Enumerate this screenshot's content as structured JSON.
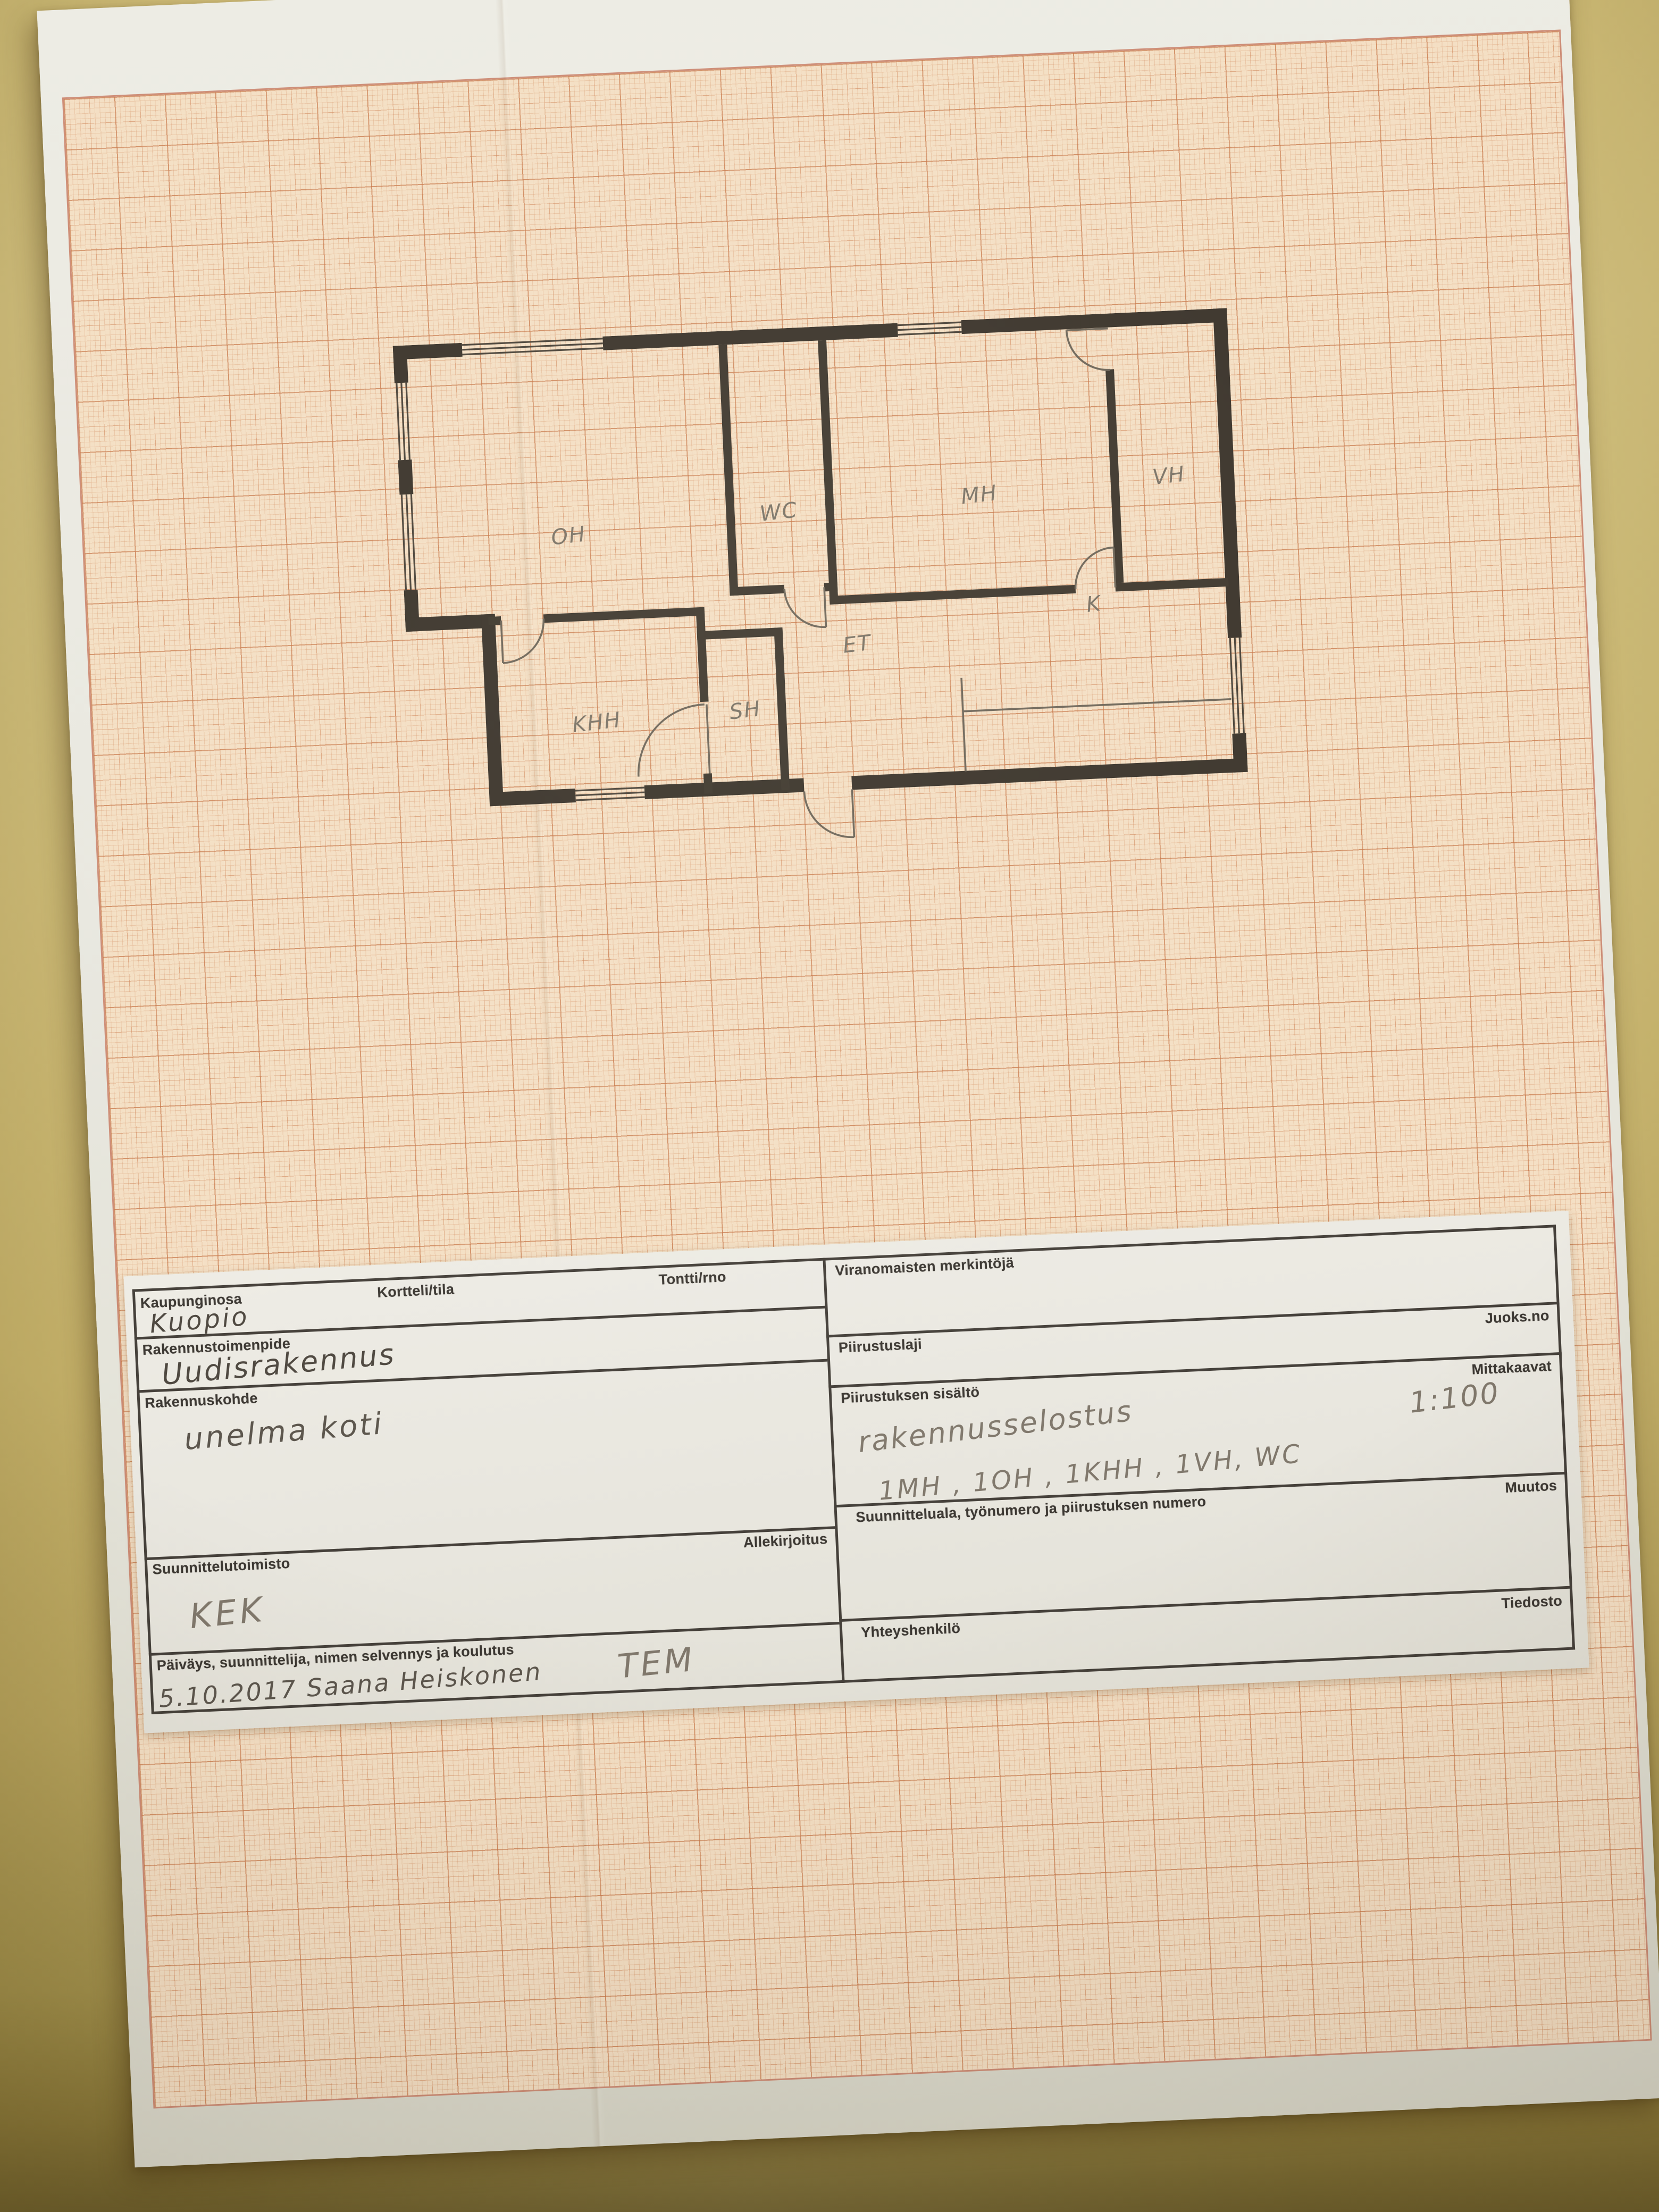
{
  "floor_plan": {
    "rooms": {
      "oh": "OH",
      "wc": "WC",
      "mh": "MH",
      "vh": "VH",
      "k": "K",
      "et": "ET",
      "khh": "KHH",
      "sh": "SH"
    },
    "scale_note": "1:100"
  },
  "title_block": {
    "kaupunginosa": {
      "label": "Kaupunginosa",
      "value": "Kuopio"
    },
    "kortteli": {
      "label": "Kortteli/tila"
    },
    "tontti": {
      "label": "Tontti/rno"
    },
    "rakennustoimenpide": {
      "label": "Rakennustoimenpide",
      "value": "Uudisrakennus"
    },
    "rakennuskohde": {
      "label": "Rakennuskohde",
      "value": "unelma koti"
    },
    "allekirjoitus": {
      "label": "Allekirjoitus"
    },
    "suunnittelutoimisto": {
      "label": "Suunnittelutoimisto",
      "value": "KEK"
    },
    "paivays": {
      "label": "Päiväys, suunnittelija, nimen selvennys ja koulutus",
      "value": "5.10.2017   Saana Heiskonen",
      "value2": "TEM"
    },
    "viranomaisten": {
      "label": "Viranomaisten merkintöjä"
    },
    "juoksno": {
      "label": "Juoks.no"
    },
    "piirustuslaji": {
      "label": "Piirustuslaji"
    },
    "mittakaavat": {
      "label": "Mittakaavat",
      "value": "1:100"
    },
    "piirustuksen_sisalto": {
      "label": "Piirustuksen sisältö",
      "value": "rakennusselostus",
      "value2": "1MH  ,  1OH ,  1KHH , 1VH, WC"
    },
    "suunnitteluala": {
      "label": "Suunnitteluala, työnumero ja piirustuksen numero"
    },
    "muutos": {
      "label": "Muutos"
    },
    "tiedosto": {
      "label": "Tiedosto"
    },
    "yhteyshenkilo": {
      "label": "Yhteyshenkilö"
    }
  }
}
